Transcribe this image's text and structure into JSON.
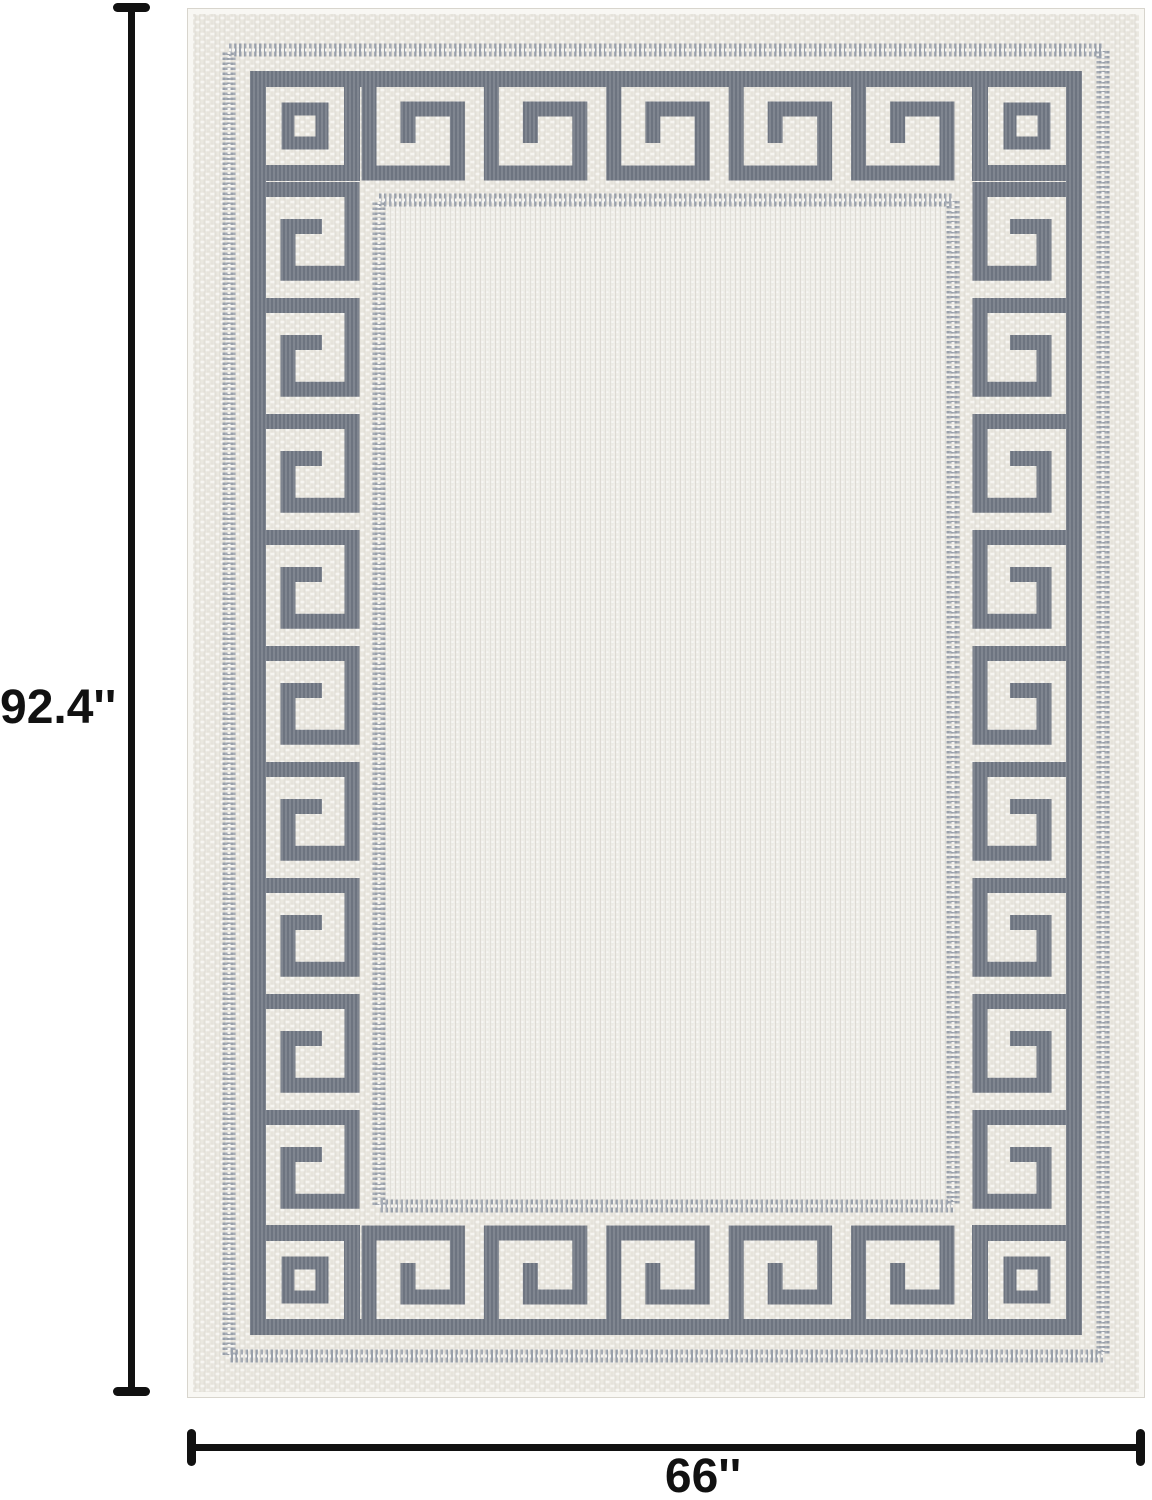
{
  "figure": {
    "subject": "greek-key-border-rug",
    "rug_pattern": "greek-key meander border with corner medallions",
    "height_label": "92.4''",
    "width_label": "66''"
  },
  "colors": {
    "dim-ink": "#111111",
    "meander-dark": "#6d7480",
    "rug-cream": "#e7e4dc",
    "rug-cream-light": "#f6f5f1",
    "rug-field": "#edece6",
    "rug-field-line": "#dcd9d2",
    "border-dot-gray": "#99a0ab",
    "rug-edge": "#f8f7f3",
    "page-bg": "#ffffff"
  }
}
